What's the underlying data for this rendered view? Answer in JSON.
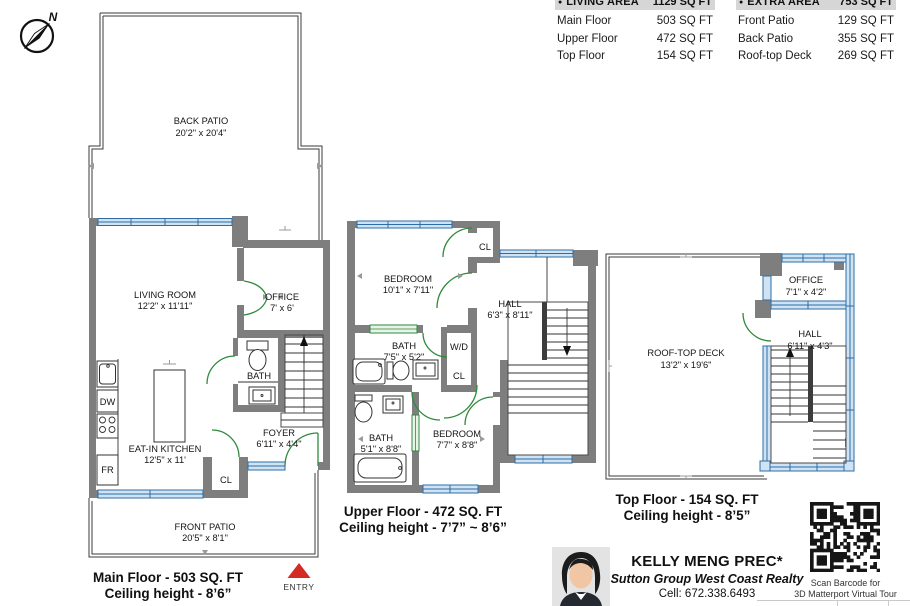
{
  "colors": {
    "wall": "#7e7e7e",
    "win": "#2e6da4",
    "winfill": "#cfe3f5",
    "door": "#2f8a3d",
    "entry": "#d42b26",
    "headerbg": "#d6d6d6"
  },
  "compass": {
    "north": "N"
  },
  "legend": {
    "bullet": "●",
    "living": {
      "title": "LIVING AREA",
      "total": "1129 SQ FT",
      "rows": [
        {
          "label": "Main Floor",
          "value": "503 SQ FT"
        },
        {
          "label": "Upper Floor",
          "value": "472 SQ FT"
        },
        {
          "label": "Top Floor",
          "value": "154 SQ FT"
        }
      ]
    },
    "extra": {
      "title": "EXTRA AREA",
      "total": "753 SQ FT",
      "rows": [
        {
          "label": "Front Patio",
          "value": "129 SQ FT"
        },
        {
          "label": "Back Patio",
          "value": "355 SQ FT"
        },
        {
          "label": "Roof-top Deck",
          "value": "269 SQ FT"
        }
      ]
    }
  },
  "floors": {
    "main": {
      "caption1": "Main Floor - 503 SQ. FT",
      "caption2": "Ceiling height - 8’6”",
      "entry": "ENTRY",
      "back_patio_name": "BACK PATIO",
      "back_patio_dims": "20'2\" x 20'4\"",
      "living_name": "LIVING ROOM",
      "living_dims": "12'2\" x 11'11\"",
      "office_name": "OFFICE",
      "office_dims": "7' x 6'",
      "bath": "BATH",
      "kitchen_name": "EAT-IN KITCHEN",
      "kitchen_dims": "12'5\" x 11'",
      "foyer_name": "FOYER",
      "foyer_dims": "6'11\" x 4'4\"",
      "cl": "CL",
      "dw": "DW",
      "fr": "FR",
      "front_patio_name": "FRONT PATIO",
      "front_patio_dims": "20'5\" x 8'1\""
    },
    "upper": {
      "caption1": "Upper Floor - 472 SQ. FT",
      "caption2": "Ceiling height - 7’7” ~ 8’6”",
      "bedroom1_name": "BEDROOM",
      "bedroom1_dims": "10'1\" x 7'11\"",
      "cl1": "CL",
      "hall_name": "HALL",
      "hall_dims": "6'3\" x 8'11\"",
      "bath1_name": "BATH",
      "bath1_dims": "7'5\" x 5'2\"",
      "wd": "W/D",
      "cl2": "CL",
      "bath2_name": "BATH",
      "bath2_dims": "5'1\" x 8'8\"",
      "bedroom2_name": "BEDROOM",
      "bedroom2_dims": "7'7\" x 8'8\""
    },
    "top": {
      "caption1": "Top Floor - 154 SQ. FT",
      "caption2": "Ceiling height - 8’5”",
      "deck_name": "ROOF-TOP DECK",
      "deck_dims": "13'2\" x 19'6\"",
      "office_name": "OFFICE",
      "office_dims": "7'1\" x 4'2\"",
      "hall_name": "HALL",
      "hall_dims": "6'11\" x 4'3\""
    }
  },
  "agent": {
    "name": "KELLY MENG PREC*",
    "company": "Sutton Group West Coast Realty",
    "phone": "Cell: 672.338.6493"
  },
  "qr": {
    "line1": "Scan Barcode for",
    "line2": "3D Matterport Virtual Tour"
  }
}
